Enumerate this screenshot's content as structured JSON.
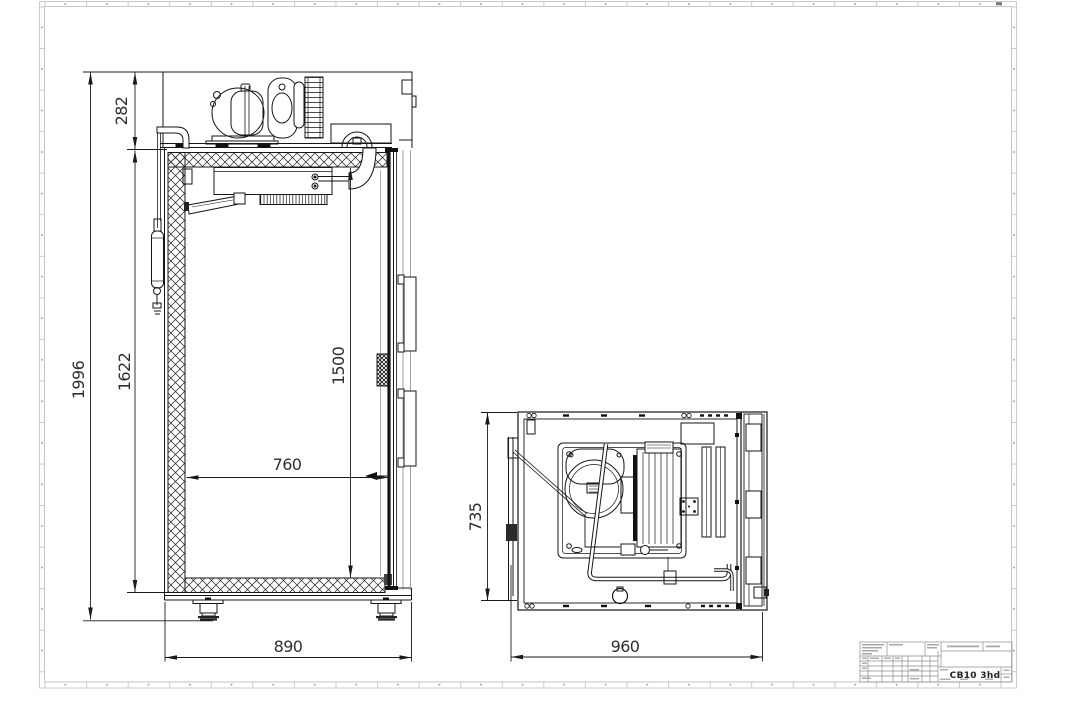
{
  "side_view": {
    "overall_height": "1996",
    "body_height": "1622",
    "machine_unit_height": "282",
    "interior_height": "1500",
    "interior_width": "760",
    "overall_width": "890"
  },
  "top_view": {
    "width": "735",
    "overall_depth": "960"
  },
  "title_block": {
    "model_name": "CB10 3hd"
  }
}
